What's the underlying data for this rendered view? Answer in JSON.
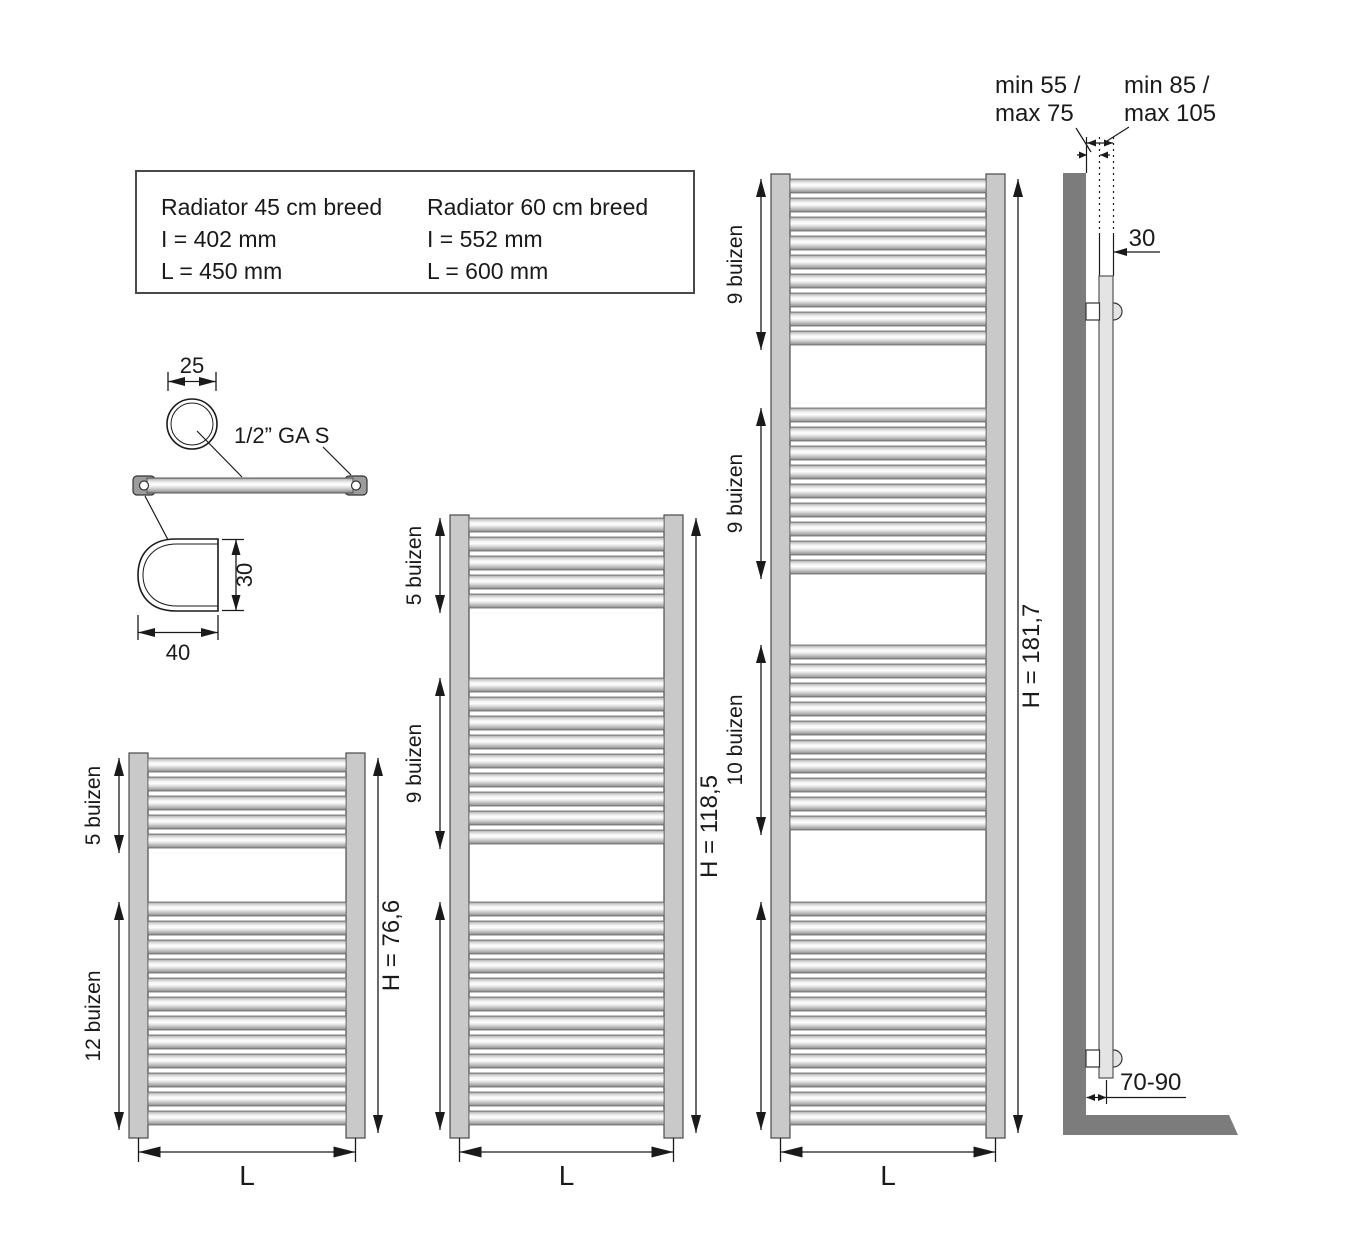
{
  "info_box": {
    "left": {
      "title": "Radiator 45 cm breed",
      "line1": "I = 402 mm",
      "line2": "L = 450 mm"
    },
    "right": {
      "title": "Radiator 60 cm breed",
      "line1": "I = 552 mm",
      "line2": "L = 600 mm"
    }
  },
  "detail": {
    "tube_diameter": "25",
    "fitting_label": "1/2” GA S",
    "profile_height": "30",
    "profile_width": "40"
  },
  "side_view": {
    "wall_distance_line1": "min 55 /",
    "wall_distance_line2": "max 75",
    "front_distance_line1": "min 85 /",
    "front_distance_line2": "max 105",
    "profile_depth": "30",
    "floor_clearance": "70-90"
  },
  "radiators": [
    {
      "name": "small",
      "height_label": "H = 76,6",
      "width_label": "L",
      "groups": [
        {
          "label": "5 buizen",
          "tubes": 5
        },
        {
          "label": "12 buizen",
          "tubes": 12
        }
      ]
    },
    {
      "name": "medium",
      "height_label": "H = 118,5",
      "width_label": "L",
      "groups": [
        {
          "label": "5 buizen",
          "tubes": 5
        },
        {
          "label": "9 buizen",
          "tubes": 9
        },
        {
          "label": "",
          "tubes": 12
        }
      ]
    },
    {
      "name": "tall",
      "height_label": "H = 181,7",
      "width_label": "L",
      "groups": [
        {
          "label": "9 buizen",
          "tubes": 9
        },
        {
          "label": "9 buizen",
          "tubes": 9
        },
        {
          "label": "10 buizen",
          "tubes": 10
        },
        {
          "label": "",
          "tubes": 12
        }
      ]
    }
  ],
  "colors": {
    "line": "#1a1a1a",
    "rail_fill": "#c9c9c9",
    "wall_fill": "#7c7c7c",
    "profile_fill": "#e4e4e4",
    "tab_fill": "#9c9c9c"
  }
}
